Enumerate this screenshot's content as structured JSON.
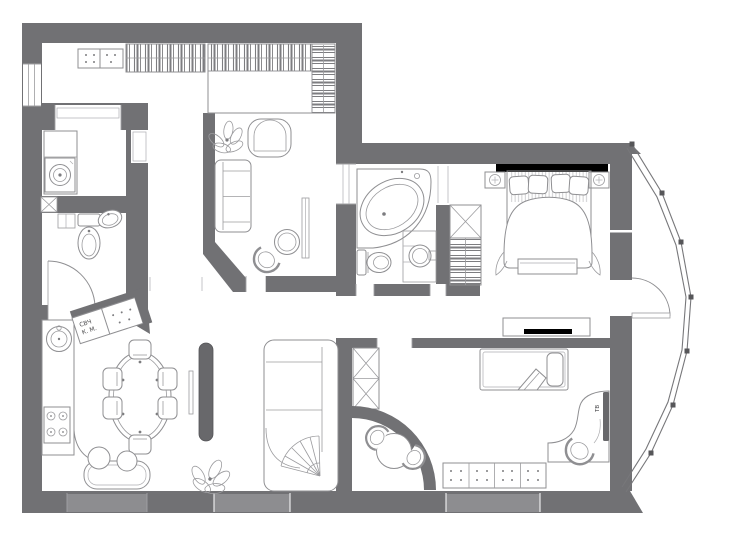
{
  "image_title": "apartment-floor-plan",
  "labels": {
    "kitchen_cabinet_line1": "СВЧ",
    "kitchen_cabinet_line2": "К. М.",
    "tv_label": "ТВ"
  },
  "colors": {
    "background": "#ffffff",
    "wall_fill": "#717174",
    "wall_dark": "#636366",
    "window_inset": "#8d8d90",
    "furniture_stroke": "#8f8f92",
    "dark_fixture": "#68686b"
  },
  "rooms": [
    {
      "id": "entry-hall",
      "fixtures": [
        "shoe-cabinet",
        "wardrobe-hangers",
        "corner-wardrobe-hangers"
      ]
    },
    {
      "id": "utility-room",
      "fixtures": [
        "counter",
        "washing-machine"
      ]
    },
    {
      "id": "wc",
      "fixtures": [
        "vent-shaft",
        "shelf",
        "toilet",
        "washbasin",
        "door-swing"
      ]
    },
    {
      "id": "living-study",
      "fixtures": [
        "plant",
        "armchair",
        "loveseat-sofa",
        "side-table",
        "tub-chair",
        "shelf"
      ]
    },
    {
      "id": "bathroom",
      "fixtures": [
        "corner-bathtub",
        "toilet",
        "washbasin-counter",
        "linen-closet"
      ]
    },
    {
      "id": "bedroom",
      "fixtures": [
        "headboard",
        "double-bed",
        "pillows",
        "nightstand-left",
        "nightstand-right",
        "foot-bench",
        "tv-console"
      ]
    },
    {
      "id": "kitchen-living-room",
      "fixtures": [
        "kitchen-counter",
        "sink",
        "cooktop",
        "angled-cabinets",
        "dining-table",
        "dining-chairs",
        "tv-partition",
        "corner-sofa",
        "banquette",
        "poufs",
        "plant"
      ]
    },
    {
      "id": "kids-room",
      "fixtures": [
        "wardrobe",
        "curved-niche-wall",
        "round-table",
        "tub-chairs",
        "single-bed",
        "desk",
        "desk-chair",
        "tv-panel",
        "chest-of-drawers"
      ]
    },
    {
      "id": "balcony",
      "fixtures": [
        "curved-glazing",
        "balcony-door-swing"
      ]
    }
  ],
  "windows": [
    "left-wall-window",
    "bottom-window-1",
    "bottom-window-2",
    "bottom-window-3"
  ]
}
